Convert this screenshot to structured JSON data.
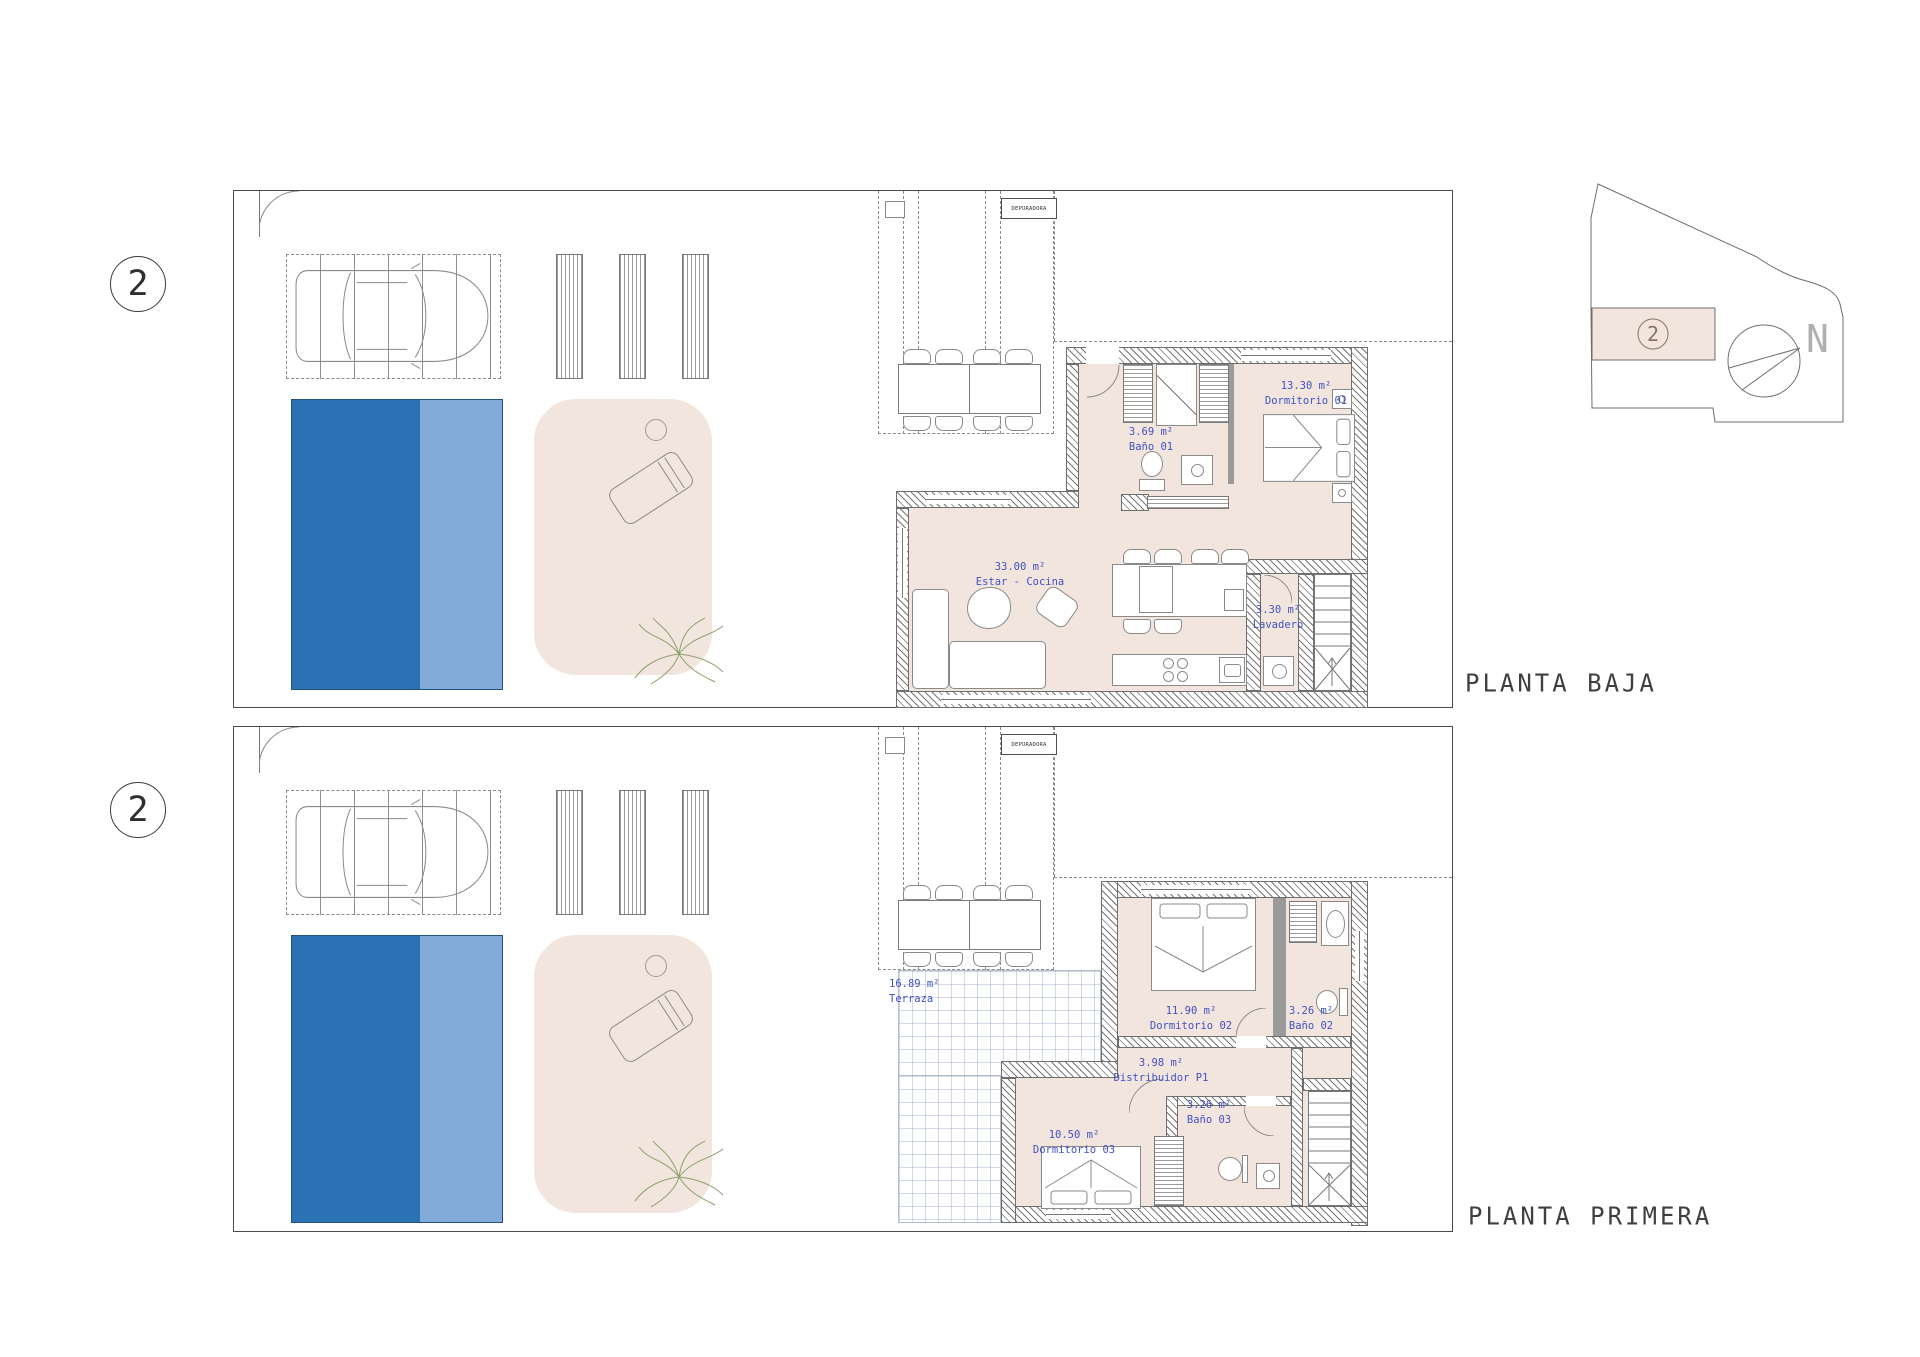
{
  "colors": {
    "pool_dark": "#2b72b4",
    "pool_light": "#82abd9",
    "interior_fill": "#f1e5dd",
    "label_blue": "#4152c4"
  },
  "site_key": {
    "marker": "2",
    "north_label": "N"
  },
  "plans": [
    {
      "title": "PLANTA BAJA",
      "marker": "2",
      "outbuilding_label": "DEPURADORA",
      "rooms": {
        "dormitorio01": {
          "area": "13.30 m²",
          "name": "Dormitorio 01"
        },
        "bano01": {
          "area": "3.69 m²",
          "name": "Baño 01"
        },
        "estar_cocina": {
          "area": "33.00 m²",
          "name": "Estar - Cocina"
        },
        "lavadero": {
          "area": "3.30 m²",
          "name": "Lavadero"
        }
      }
    },
    {
      "title": "PLANTA PRIMERA",
      "marker": "2",
      "outbuilding_label": "DEPURADORA",
      "rooms": {
        "terraza": {
          "area": "16.89 m²",
          "name": "Terraza"
        },
        "dormitorio02": {
          "area": "11.90 m²",
          "name": "Dormitorio 02"
        },
        "bano02": {
          "area": "3.26 m²",
          "name": "Baño 02"
        },
        "distribuidor": {
          "area": "3.98 m²",
          "name": "Distribuidor P1"
        },
        "bano03": {
          "area": "3.26 m²",
          "name": "Baño 03"
        },
        "dormitorio03": {
          "area": "10.50 m²",
          "name": "Dormitorio 03"
        }
      }
    }
  ]
}
